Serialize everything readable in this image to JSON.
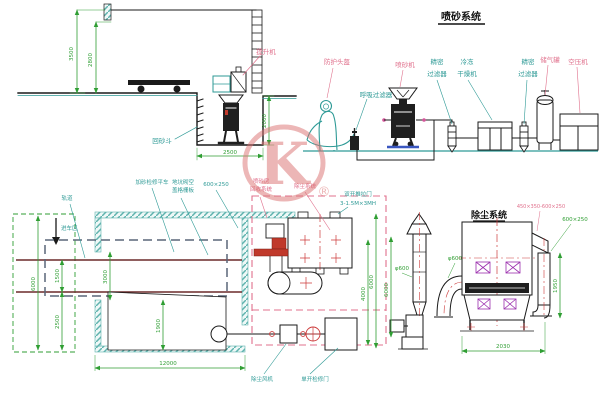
{
  "colors": {
    "line": "#1a1a1a",
    "teal": "#2e9a96",
    "green": "#2f9e33",
    "pink": "#e0708c",
    "red_centerline": "#cc3a3a",
    "rail": "#6b2a2a",
    "car_dash": "#5a6678",
    "watermark": "#db7070"
  },
  "watermark": {
    "letter": "K",
    "registered": "®"
  },
  "blast_system": {
    "title": "喷砂系统",
    "labels": {
      "helmet": "防护头盔",
      "breath_filter": "呼吸过滤器",
      "blast_machine": "喷砂机",
      "filter1_l1": "精密",
      "filter1_l2": "过滤器",
      "dryer_l1": "冷冻",
      "dryer_l2": "干燥机",
      "filter2_l1": "精密",
      "filter2_l2": "过滤器",
      "air_tank": "储气罐",
      "compressor": "空压机"
    }
  },
  "elevation": {
    "labels": {
      "hoist": "提升机",
      "sand_hopper": "回砂斗"
    },
    "dims": {
      "wall_height": "3500",
      "inner_height": "2800",
      "pit_depth": "2000",
      "pit_width": "2500"
    }
  },
  "plan": {
    "labels": {
      "rail": "轨道",
      "entry": "进车区",
      "flat_car": "加砂检修平车",
      "pit_cover_l1": "地坑砌空",
      "pit_cover_l2": "盖格栅板",
      "duct_size": "600×250",
      "room_l1": "喷砂房",
      "room_l2": "回收系统",
      "dust_area": "除尘系统",
      "door_l1": "双开推拉门",
      "door_l2": "3-1.5M×3MH",
      "dust_fan": "除尘风机",
      "service_door": "单开检修门"
    },
    "dims": {
      "room_height": "6000",
      "rail_gauge": "1500",
      "opening": "3000",
      "lower_span": "2500",
      "door_width": "1900",
      "room_length": "12000",
      "area_width": "4000",
      "area_height": "6000"
    }
  },
  "dust_system": {
    "title": "除尘系统",
    "dims": {
      "stack_dia": "φ600",
      "duct_dia": "φ600",
      "transition": "450×350-600×250",
      "inlet_duct": "600×250",
      "inlet_height": "1950",
      "body_width": "2030",
      "stack_height": "6000"
    }
  }
}
